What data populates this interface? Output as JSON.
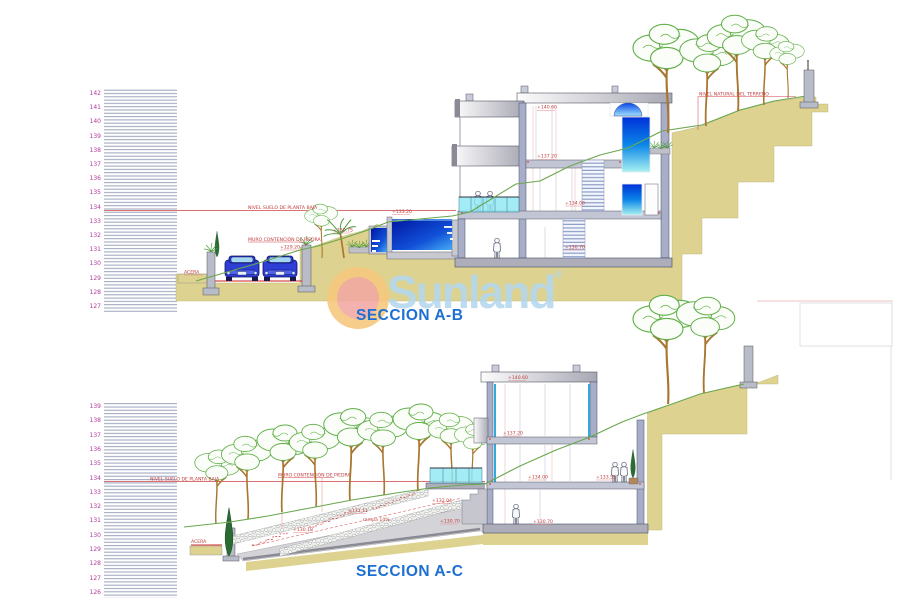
{
  "watermark": {
    "brand": "Sunland",
    "registered": "®"
  },
  "scale_top": {
    "values": [
      "142",
      "141",
      "140",
      "139",
      "138",
      "137",
      "136",
      "135",
      "134",
      "133",
      "132",
      "131",
      "130",
      "129",
      "128",
      "127"
    ]
  },
  "scale_bottom": {
    "values": [
      "139",
      "138",
      "137",
      "136",
      "135",
      "134",
      "133",
      "132",
      "131",
      "130",
      "129",
      "128",
      "127",
      "126"
    ]
  },
  "section_ab": {
    "title": "SECCION A-B",
    "labels": {
      "nivel_suelo": "NIVEL SUELO DE PLANTA BAJA",
      "muro": "MURO CONTENCIÓN DE PIEDRA",
      "acera": "ACERA",
      "nivel_natural": "NIVEL NATURAL DEL TERRENO",
      "cota_roof": "+140.60",
      "cota_planta_primera": "+137.20",
      "cota_planta_baja": "+134.00",
      "cota_sotano": "+130.70",
      "cota_piscina": "+133.20",
      "cota_jardinera": "+130.75",
      "cota_muro_calle": "+129.20"
    }
  },
  "section_ac": {
    "title": "SECCION A-C",
    "labels": {
      "nivel_suelo": "NIVEL SUELO DE PLANTA BAJA",
      "muro": "MURO CONTENCIÓN DE PIEDRA",
      "acera": "ACERA",
      "cota_roof": "+140.60",
      "cota_planta_primera": "+137.20",
      "cota_planta_baja": "+134.00",
      "cota_terraza": "+133.55",
      "cota_sotano": "+130.70",
      "cota_rampa_base": "+130.70",
      "cota_escalon_3": "+132.04",
      "cota_escalon_2": "+131.11",
      "cota_escalon_1": "+130.18",
      "rampa": "rampa 14%"
    }
  },
  "colors": {
    "label_red": "#c03a3a",
    "line_red": "#d04040",
    "terrain_tan": "#ddd28f",
    "vegetation_green": "#5fae46",
    "terrain_line_green": "#69a74e",
    "water_dark": "#0016a0",
    "water_light": "#3fa0f0",
    "glass_cyan": "#8fe8f4",
    "title_blue": "#1d6fd2",
    "watermark_blue": "#b5d8ee",
    "logo_outer": "#f7c77d",
    "logo_inner": "#f2a8a2",
    "scale_number_magenta": "#b5399b"
  }
}
